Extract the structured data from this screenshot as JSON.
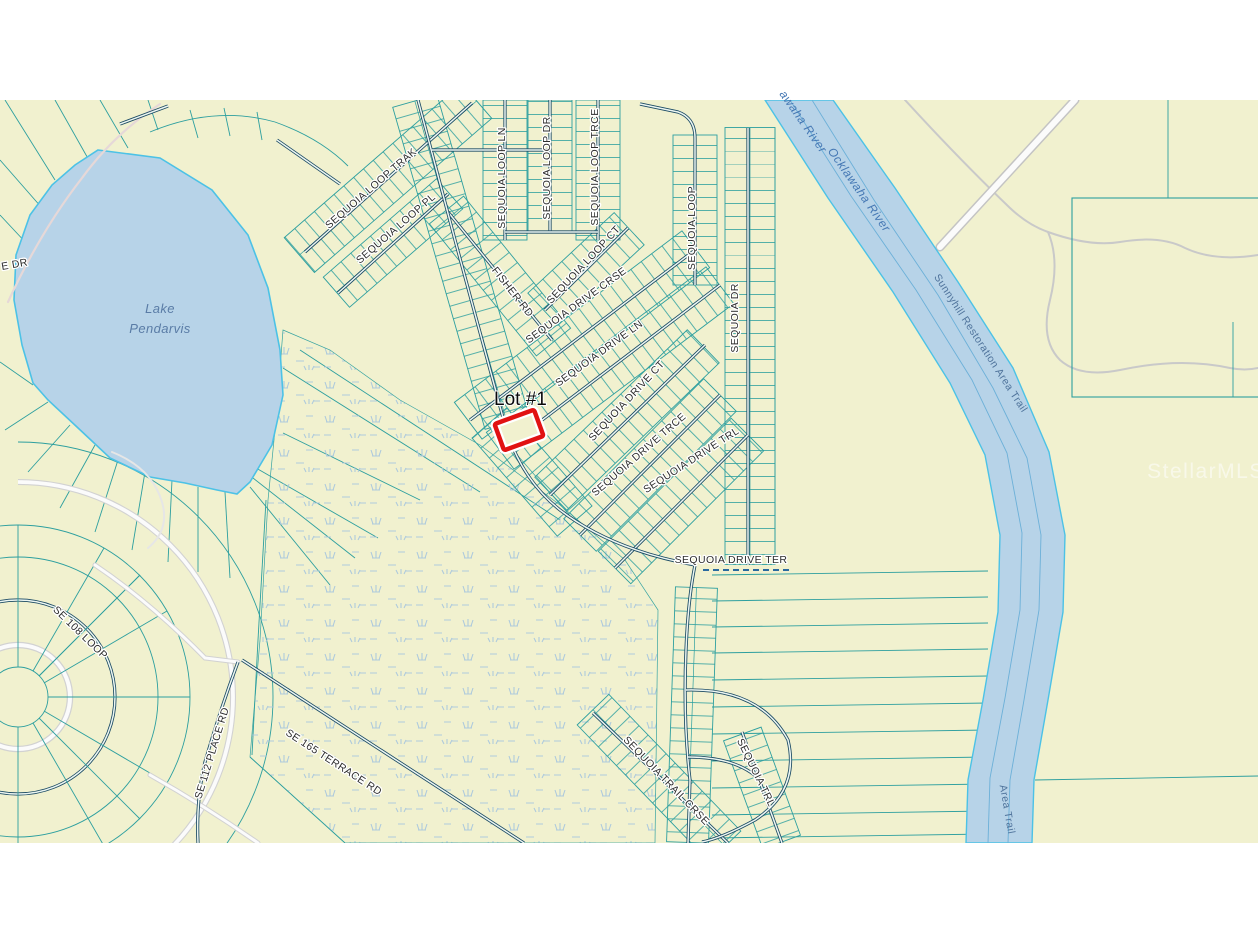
{
  "map": {
    "colors": {
      "land": "#f1f1cf",
      "water": "#b7d3e8",
      "waterEdge": "#4cc2e6",
      "riverInner": "#6cb0d8",
      "parcel": "#2d9f9f",
      "roadDark": "#1b4a63",
      "roadFill": "#ecf6f2",
      "grayRoad": "#d2d2d2",
      "grayRoadFill": "#fbfbfb",
      "pinkRoad": "#e6d8d8",
      "marsh": "#abc8dd",
      "label": "#2d2d2d",
      "waterLabel": "#4578b4",
      "trailLabel": "#50749c",
      "lakeLabel": "#5a7ca6",
      "lotHighlight": "#e11212",
      "dashedRoad": "#2a6aa0",
      "watermark": "#ffffff"
    },
    "lot_marker": {
      "label": "Lot #1"
    },
    "watermark_text": "StellarMLS",
    "water_features": [
      {
        "name": "Lake Pendarvis"
      },
      {
        "name": "Ocklawaha River"
      },
      {
        "name": "Sunnyhill Restoration Area Trail"
      }
    ],
    "labels": [
      {
        "id": "e-dr",
        "text": "E DR",
        "x": 2,
        "y": 270,
        "rot": -10,
        "cls": "street",
        "anchor": "start"
      },
      {
        "id": "lake-pendarvis-line1",
        "text": "Lake",
        "x": 160,
        "y": 313,
        "rot": 0,
        "cls": "lake"
      },
      {
        "id": "lake-pendarvis-line2",
        "text": "Pendarvis",
        "x": 160,
        "y": 333,
        "rot": 0,
        "cls": "lake"
      },
      {
        "id": "sequoia-loop-trak",
        "text": "SEQUOIA LOOP TRAK",
        "x": 373,
        "y": 191,
        "rot": -41,
        "cls": "street"
      },
      {
        "id": "sequoia-loop-pl",
        "text": "SEQUOIA LOOP PL",
        "x": 398,
        "y": 231,
        "rot": -41,
        "cls": "street"
      },
      {
        "id": "sequoia-loop-ln",
        "text": "SEQUOIA LOOP LN",
        "x": 505,
        "y": 178,
        "rot": -90,
        "cls": "street"
      },
      {
        "id": "sequoia-loop-dr",
        "text": "SEQUOIA LOOP DR",
        "x": 550,
        "y": 168,
        "rot": -90,
        "cls": "street"
      },
      {
        "id": "sequoia-loop-trce",
        "text": "SEQUOIA LOOP TRCE",
        "x": 598,
        "y": 167,
        "rot": -90,
        "cls": "street"
      },
      {
        "id": "sequoia-loop-ct",
        "text": "SEQUOIA LOOP CT",
        "x": 586,
        "y": 267,
        "rot": -47,
        "cls": "street"
      },
      {
        "id": "sequoia-loop",
        "text": "SEQUOIA LOOP",
        "x": 695,
        "y": 228,
        "rot": -90,
        "cls": "street"
      },
      {
        "id": "fisher-rd",
        "text": "FISHER RD",
        "x": 510,
        "y": 294,
        "rot": 52,
        "cls": "street"
      },
      {
        "id": "sequoia-drive-crse",
        "text": "SEQUOIA DRIVE CRSE",
        "x": 578,
        "y": 308,
        "rot": -36,
        "cls": "street"
      },
      {
        "id": "sequoia-drive-ln",
        "text": "SEQUOIA DRIVE LN",
        "x": 601,
        "y": 356,
        "rot": -36,
        "cls": "street"
      },
      {
        "id": "sequoia-drive-ct",
        "text": "SEQUOIA DRIVE CT",
        "x": 629,
        "y": 403,
        "rot": -47,
        "cls": "street"
      },
      {
        "id": "sequoia-drive-trce",
        "text": "SEQUOIA DRIVE TRCE",
        "x": 641,
        "y": 457,
        "rot": -41,
        "cls": "street"
      },
      {
        "id": "sequoia-drive-trl",
        "text": "SEQUOIA DRIVE TRL",
        "x": 693,
        "y": 463,
        "rot": -33,
        "cls": "street"
      },
      {
        "id": "sequoia-dr",
        "text": "SEQUOIA DR",
        "x": 738,
        "y": 318,
        "rot": -90,
        "cls": "street"
      },
      {
        "id": "sequoia-drive-ter",
        "text": "SEQUOIA DRIVE TER",
        "x": 731,
        "y": 563,
        "rot": 0,
        "cls": "street"
      },
      {
        "id": "sequoia-trail-crse",
        "text": "SEQUOIA TRAIL CRSE",
        "x": 664,
        "y": 783,
        "rot": 46,
        "cls": "street"
      },
      {
        "id": "sequoia-trl",
        "text": "SEQUOIA TRL",
        "x": 753,
        "y": 774,
        "rot": 64,
        "cls": "street"
      },
      {
        "id": "se-108-loop",
        "text": "SE 108 LOOP",
        "x": 78,
        "y": 635,
        "rot": 44,
        "cls": "street"
      },
      {
        "id": "se-112-place-rd",
        "text": "SE 112 PLACE RD",
        "x": 215,
        "y": 754,
        "rot": -73,
        "cls": "street"
      },
      {
        "id": "se-165-terrace-rd",
        "text": "SE 165 TERRACE RD",
        "x": 332,
        "y": 765,
        "rot": 33,
        "cls": "street"
      },
      {
        "id": "ocklawaha-river-part",
        "text": "awaha River",
        "x": 800,
        "y": 124,
        "rot": 55,
        "cls": "water"
      },
      {
        "id": "ocklawaha-river",
        "text": "Ocklawaha River",
        "x": 856,
        "y": 192,
        "rot": 55,
        "cls": "water"
      },
      {
        "id": "sunnyhill-trail",
        "text": "Sunnyhill Restoration Area Trail",
        "x": 978,
        "y": 345,
        "rot": 57,
        "cls": "trail"
      },
      {
        "id": "area-trail-part",
        "text": "Area Trail",
        "x": 1004,
        "y": 810,
        "rot": 80,
        "cls": "trail"
      },
      {
        "id": "lot-1",
        "text": "Lot #1",
        "x": 494,
        "y": 405,
        "rot": 0,
        "cls": "lot",
        "anchor": "start"
      },
      {
        "id": "watermark",
        "text": "StellarMLS",
        "x": 1206,
        "y": 478,
        "rot": 0,
        "cls": "watermark"
      }
    ]
  }
}
